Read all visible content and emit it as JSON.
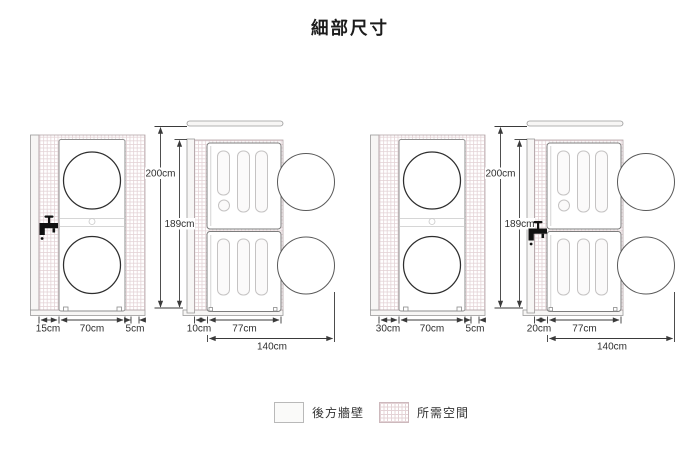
{
  "title": "細部尺寸",
  "legend": {
    "rear_wall_label": "後方牆壁",
    "required_space_label": "所需空間"
  },
  "diagrams": {
    "left": {
      "front": {
        "left_gap": "15cm",
        "machine_width": "70cm",
        "right_gap": "5cm"
      },
      "side": {
        "total_height": "200cm",
        "machine_height": "189cm",
        "rear_gap": "10cm",
        "machine_depth": "77cm",
        "total_depth": "140cm"
      }
    },
    "right": {
      "front": {
        "left_gap": "30cm",
        "machine_width": "70cm",
        "right_gap": "5cm"
      },
      "side": {
        "total_height": "200cm",
        "machine_height": "189cm",
        "rear_gap": "20cm",
        "machine_depth": "77cm",
        "total_depth": "140cm"
      }
    }
  },
  "colors": {
    "hatch_grid": "#e4d3d6",
    "wall_fill": "#f7f6f5",
    "dimension_line": "#3a3a3a",
    "door_stroke": "#2e2e2e",
    "background": "#ffffff"
  }
}
